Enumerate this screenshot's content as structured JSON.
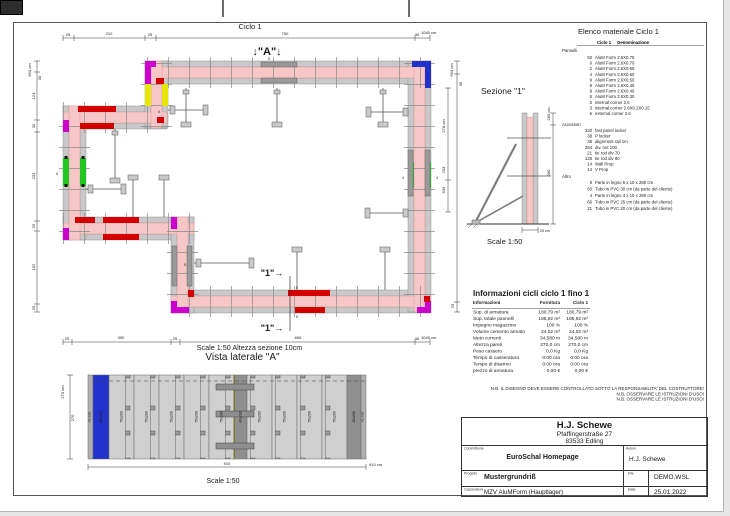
{
  "page": {
    "plan": {
      "title": "Ciclo 1",
      "marker_a": "↓\"A\"↓",
      "marker_a_sub": "5",
      "marker_1": "\"1\"→",
      "scale_note": "Scale 1:50   Altezza sezione 10cm",
      "dims_top": [
        "25",
        "210",
        "25",
        "750",
        "30",
        "1045 cm"
      ],
      "dims_left": [
        "654 cm",
        "30",
        "124",
        "30",
        "233",
        "25",
        "192",
        "25"
      ],
      "dims_right": [
        "694 cm",
        "30",
        "278 cm",
        "203",
        "639",
        "25"
      ],
      "dims_bottom": [
        "25",
        "300",
        "25",
        "665",
        "30",
        "1045 cm"
      ],
      "prop_label_4": "4",
      "prop_label_5": "5",
      "green_left_label": "5",
      "green_right_label_a": "4",
      "green_right_label_b": "4",
      "joint_label_a": "5",
      "joint_label_b": "5"
    },
    "sezione": {
      "title": "Sezione  \"1\"",
      "dim_total": "280 cm",
      "dim_mid": "280",
      "dim_width": "25 cm",
      "scale": "Scale 1:50"
    },
    "lateral": {
      "title": "Vista laterale \"A\"",
      "scale": "Scale 1:50",
      "dim_left_total": "270 cm",
      "dim_left": "270",
      "dim_bottom": "910",
      "dim_bottom_total": "910 cm",
      "panels": [
        "AE 2/60",
        "50x260",
        "75x260",
        "75x260",
        "75x260",
        "75x260",
        "75x260",
        "40x260",
        "75x260",
        "75x260",
        "75x260",
        "75x260",
        "45x260",
        "AE 2/60"
      ]
    },
    "material_list": {
      "title": "Elenco materiale  Ciclo 1",
      "col_ciclo": "Ciclo 1",
      "col_denominazione": "Denominazione",
      "pannelli_label": "Pannelli",
      "accessori_label": "Accessori",
      "altro_label": "Altro",
      "pannelli": [
        {
          "qty": "50",
          "name": "AluM Form 2.6X0.75"
        },
        {
          "qty": "6",
          "name": "AluM Form 2.6X0.70"
        },
        {
          "qty": "2",
          "name": "AluM Form 2.6X0.65"
        },
        {
          "qty": "4",
          "name": "AluM Form 2.6X0.60"
        },
        {
          "qty": "9",
          "name": "AluM Form 2.6X0.50"
        },
        {
          "qty": "9",
          "name": "AluM Form 2.6X0.45"
        },
        {
          "qty": "9",
          "name": "AluM Form 2.6X0.40"
        },
        {
          "qty": "6",
          "name": "AluM Form 2.6X0.30"
        },
        {
          "qty": "5",
          "name": "internal corner 2.6"
        },
        {
          "qty": "3",
          "name": "internal corner 2.6X0.2X0.15"
        },
        {
          "qty": "6",
          "name": "external corner 2.6"
        }
      ],
      "accessori": [
        {
          "qty": "320",
          "name": "fast panel locker"
        },
        {
          "qty": "38",
          "name": "P locker"
        },
        {
          "qty": "38",
          "name": "alignment rail 1m"
        },
        {
          "qty": "294",
          "name": "div. nut 100"
        },
        {
          "qty": "21",
          "name": "tie rod div 70"
        },
        {
          "qty": "128",
          "name": "tie rod div 80"
        },
        {
          "qty": "14",
          "name": "Wall Prop"
        },
        {
          "qty": "14",
          "name": "V Prop"
        }
      ],
      "altro": [
        {
          "qty": "8",
          "name": "Parte in legno 5 x 10 x 280 cm"
        },
        {
          "qty": "50",
          "name": "Tubo in PVC 30 cm (da parte del cliente)"
        },
        {
          "qty": "4",
          "name": "Parte in legno 4 x 10 x 280 cm"
        },
        {
          "qty": "66",
          "name": "Tubo in PVC 25 cm (da parte del cliente)"
        },
        {
          "qty": "21",
          "name": "Tubo in PVC 20 cm (da parte del cliente)"
        }
      ]
    },
    "info_table": {
      "title": "Informazioni cicli  ciclo 1 fino 1",
      "headers": [
        "Informazioni",
        "Fornitura",
        "Ciclo 1"
      ],
      "rows": [
        [
          "Sup. di armatura",
          "180,79 m²",
          "180,79 m²"
        ],
        [
          "Sup. totale pannelli",
          "185,92 m²",
          "185,92 m²"
        ],
        [
          "Impegno magazzino",
          "100 %",
          "100 %"
        ],
        [
          "Volume cemento armato",
          "24,02 m³",
          "24,02 m³"
        ],
        [
          "Metri correnti",
          "34,580 m",
          "34,580 m"
        ],
        [
          "Altezza pareti",
          "270,0 cm",
          "270,0 cm"
        ],
        [
          "Peso cassero",
          "0,0 Kg",
          "0,0 Kg"
        ],
        [
          "Tempo di casseratura",
          "0:00 ora",
          "0:00 ora"
        ],
        [
          "Tempo di disarmo",
          "0:00 ora",
          "0:00 ora"
        ],
        [
          "prezzo di armatura",
          "0,00 €",
          "0,00 €"
        ]
      ]
    },
    "notes": [
      "N.B. IL DISEGNO DEVE ESSERE CONTROLLATO SOTTO LA RESPONSABILITA' DEL COSTRUTTORE!",
      "N.B. OSSERVARE LE ISTRUZIONI D'USO!",
      "N.B. OSSERVARE LE ISTRUZIONI D'USO!"
    ],
    "title_block": {
      "company": "H.J. Schewe",
      "address1": "Pfaffingerstraße 27",
      "address2": "83533 Edling",
      "committente_label": "Committente",
      "committente": "EuroSchal Homepage",
      "autore_label": "Autore",
      "autore": "H.J. Schewe",
      "progetto_label": "Progetto",
      "progetto": "Mustergrundriß",
      "file_label": "File",
      "file": "DEMO.WSL",
      "casseratura_label": "Casseratura",
      "casseratura": "MZV AluMForm (Hauptlager)",
      "data_label": "Data",
      "data": "25.01.2022"
    },
    "colors": {
      "wall_core": "#f7c6c6",
      "panel_gray": "#c9c9c9",
      "corner_magenta": "#cc00cc",
      "panel_red": "#d40000",
      "panel_yellow": "#e6e600",
      "panel_green": "#22c822",
      "panel_blue": "#2030c8"
    }
  }
}
